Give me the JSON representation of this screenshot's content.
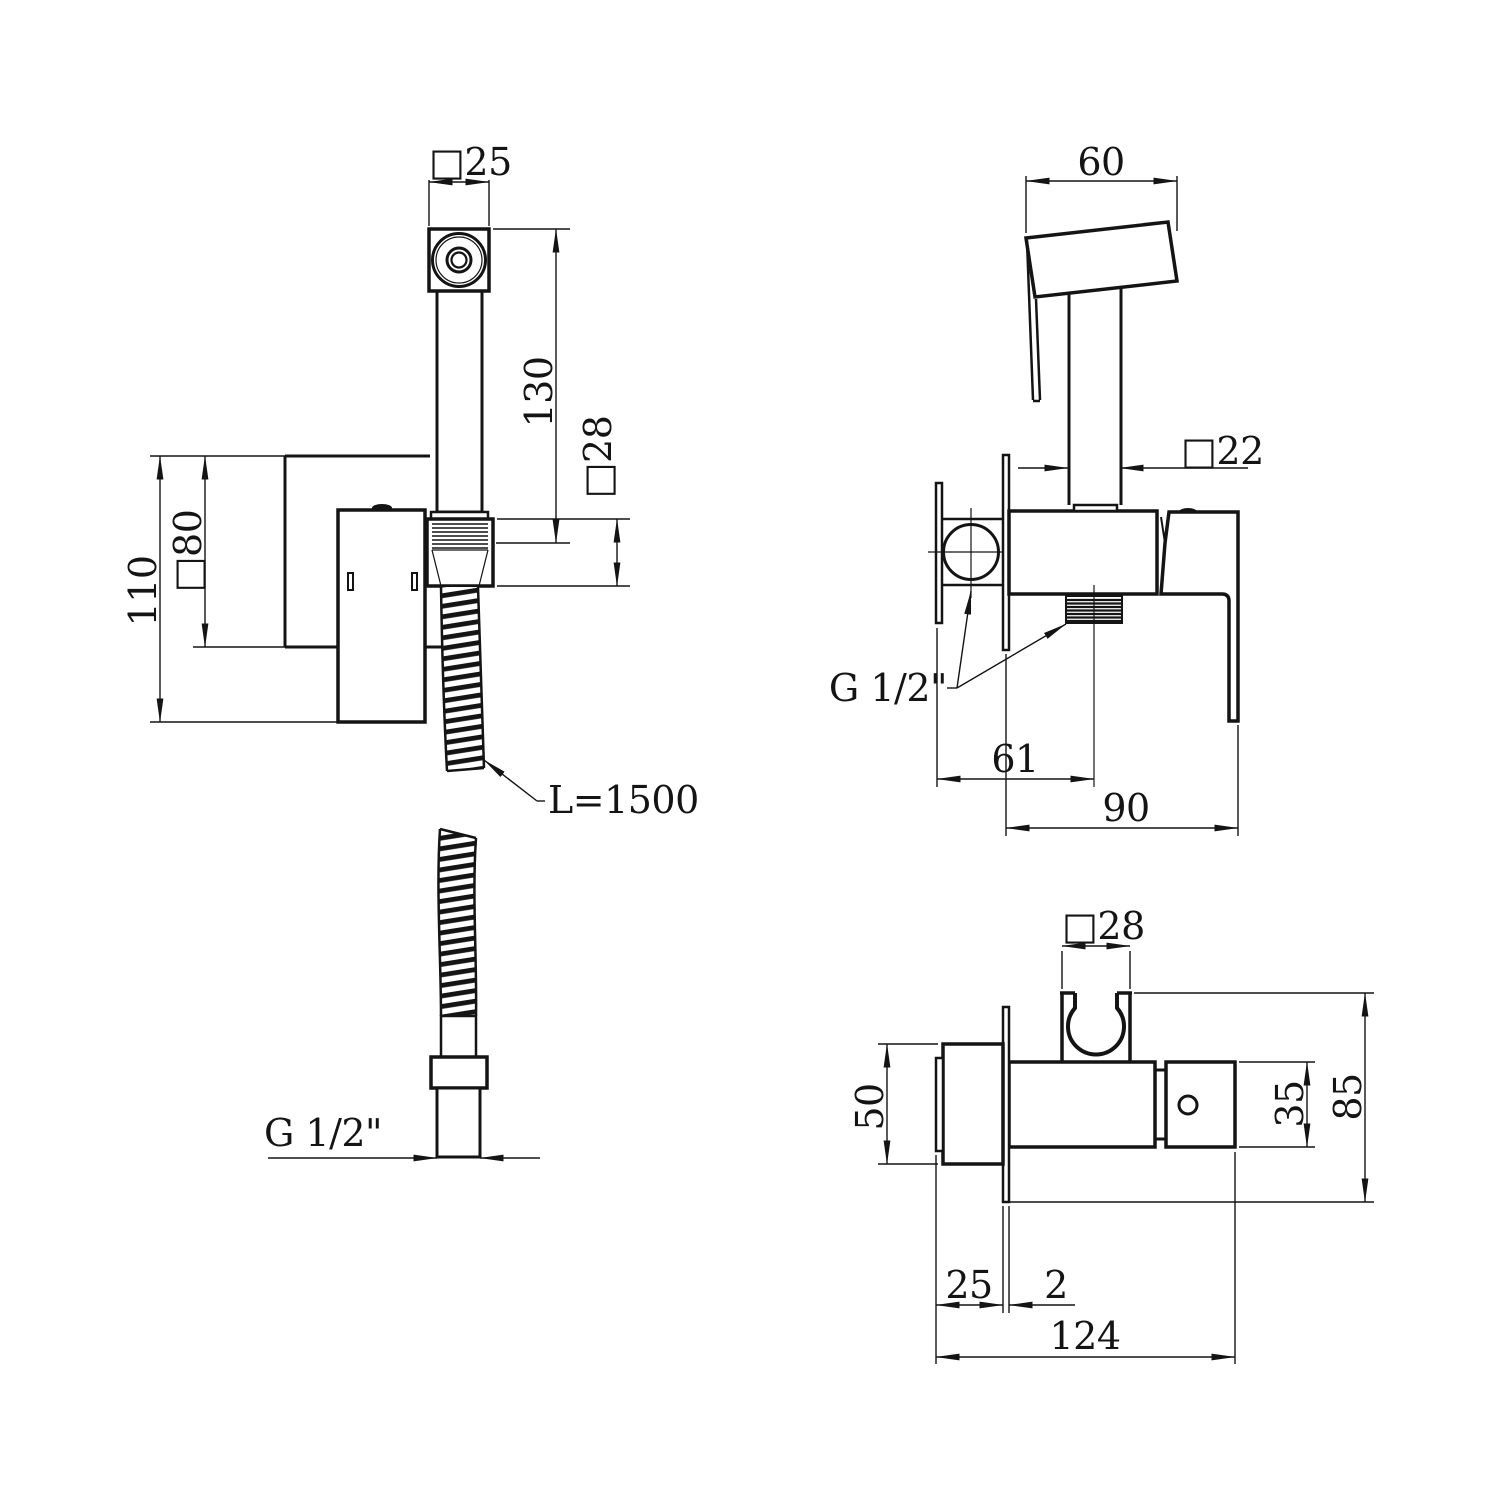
{
  "colors": {
    "background": "#ffffff",
    "line": "#141414"
  },
  "views": {
    "front": {
      "dims": {
        "head_width": "□25",
        "handle_length": "130",
        "connector_size": "□28",
        "plate_size": "□80",
        "overall_height": "110",
        "hose_length": "L=1500",
        "hose_thread": "G 1/2\""
      }
    },
    "side": {
      "dims": {
        "head_depth": "60",
        "shaft_size": "□22",
        "thread": "G 1/2\"",
        "outlet_offset": "61",
        "overall_depth": "90"
      }
    },
    "top": {
      "dims": {
        "holder_size": "□28",
        "escutcheon_height": "50",
        "lever_height": "35",
        "overall_height": "85",
        "escutcheon_depth": "25",
        "plate_thickness": "2",
        "overall_depth": "124"
      }
    }
  }
}
